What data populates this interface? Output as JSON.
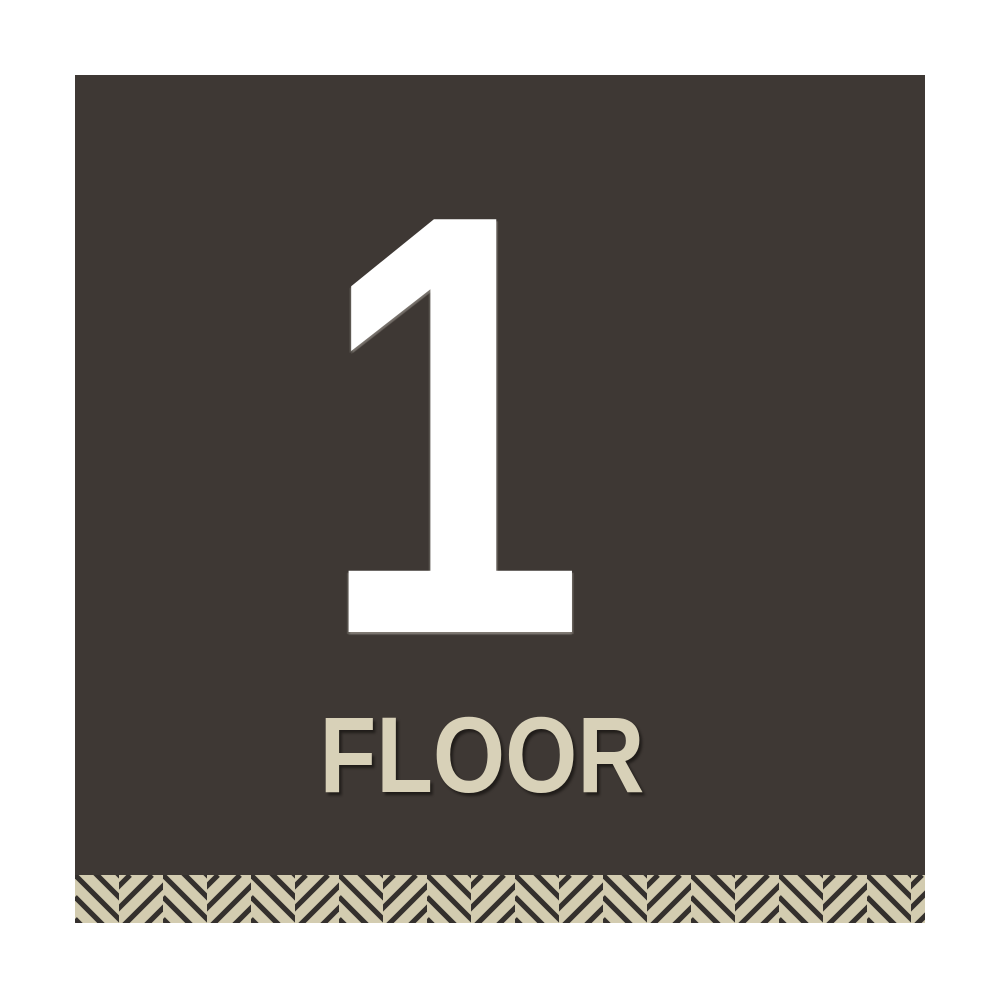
{
  "sign": {
    "floor_number": "1",
    "floor_label": "FLOOR",
    "colors": {
      "page_background": "#ffffff",
      "background": "#3e3834",
      "number": "#ffffff",
      "label": "#d8d1b8",
      "pattern_beige": "#d3ccb0",
      "pattern_dark": "#34302d"
    }
  }
}
